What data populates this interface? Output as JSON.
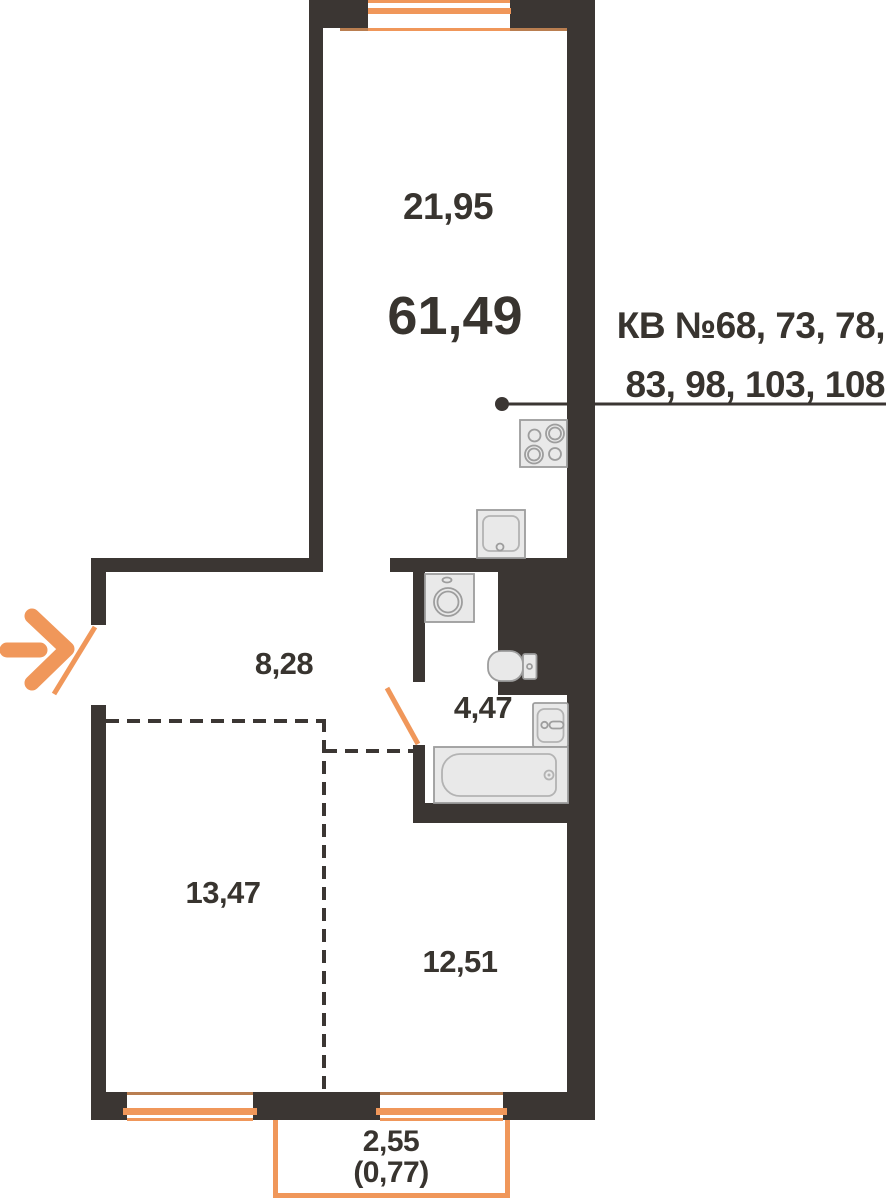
{
  "plan": {
    "title_total_area": "61,49",
    "apartment_numbers": {
      "line1": "КВ №68, 73, 78,",
      "line2": "83, 98, 103, 108"
    },
    "rooms": {
      "living_kitchen_area": "21,95",
      "hallway_area": "8,28",
      "bathroom_area": "4,47",
      "room_left_area": "13,47",
      "room_right_area": "12,51"
    },
    "balcony": {
      "area": "2,55",
      "area_with_coefficient": "(0,77)"
    },
    "icons": [
      "entrance-arrow-icon",
      "entry-door-icon",
      "bathroom-door-icon",
      "stove-icon",
      "kitchen-sink-icon",
      "washing-machine-icon",
      "toilet-icon",
      "bathroom-sink-icon",
      "bathtub-icon",
      "callout-dot"
    ],
    "colors": {
      "wall": "#3b3633",
      "accent_orange": "#f0975a",
      "accent_muted": "#b97e50",
      "text": "#38342f",
      "fixture_fill": "#e9e9e9",
      "fixture_stroke": "#9d9d9d"
    }
  }
}
